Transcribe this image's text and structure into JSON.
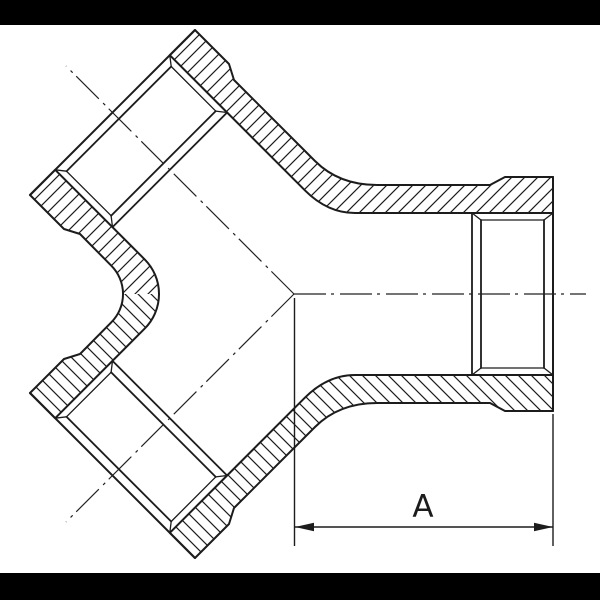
{
  "title": "Sectional technical drawing of a symmetric Y-branch (twin 45° inlet) threaded pipe fitting",
  "dimension": {
    "label": "A"
  },
  "colors": {
    "line": "#1c1c1c",
    "background": "#ffffff",
    "letterbox": "#000000"
  },
  "drawing": {
    "type": "cross-section",
    "features": [
      "two 45-degree socket inlets upper-left and lower-left",
      "one horizontal socket outlet at right",
      "internal thread representation in each socket",
      "section hatching",
      "dash-dot centerlines meeting at fitting center",
      "dimension A from fitting center to right end face"
    ]
  }
}
